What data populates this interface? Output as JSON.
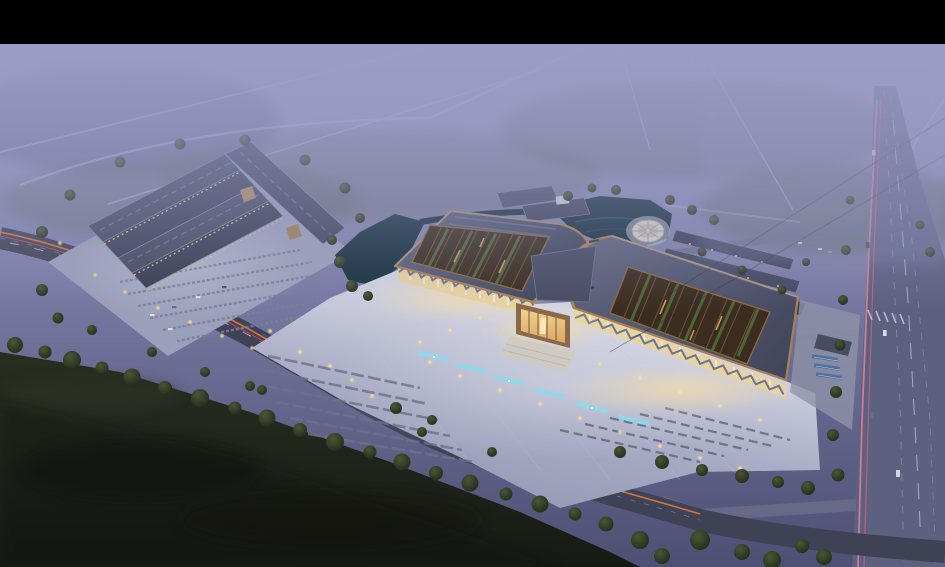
{
  "scene": {
    "palette": {
      "letterbox": "#000000",
      "sky_top": "#9a9dc6",
      "sky_mid": "#8588b2",
      "sky_low": "#6b6e95",
      "dusk_ground": "#4d5073",
      "fog": "#999cc4",
      "forest_dark": "#171a14",
      "forest_mid": "#272e20",
      "tree_dark": "#222b1b",
      "tree_light": "#4a5733",
      "water": "#16303d",
      "water_light": "#2e5a6d",
      "road_asphalt": "#3e4254",
      "road_light": "#5d6180",
      "lane_marking": "#9ba0bb",
      "trail_orange": "#e0763c",
      "trail_red": "#c9485a",
      "trail_pink": "#e87f9a",
      "headlight_white": "#e6edf8",
      "roof_light": "#5d637b",
      "roof_dark": "#3f4459",
      "roof_copper": "#a87f50",
      "ridge_highlight": "#9aa0b6",
      "courtyard_base": "#3a2d1f",
      "courtyard_wood": "#6b5236",
      "courtyard_green": "#55663a",
      "facade_glow": "#e8d3a2",
      "atrium_glow": "#f3cf8e",
      "atrium_frame": "#8a6848",
      "canopy_steel": "#6d7390",
      "plaza_bright": "#d3d5e3",
      "plaza_base": "#a6aac3",
      "plaza_far": "#9599b4",
      "parking_stripe": "#6d7288",
      "fountain_cyan": "#8fd8ea",
      "lamp_warm": "#ffd98f",
      "circular_plaza": "#d6d2c6",
      "car_light": "#d8dee8",
      "car_dark": "#47536e",
      "solar_blue": "#4f6fa0"
    }
  }
}
